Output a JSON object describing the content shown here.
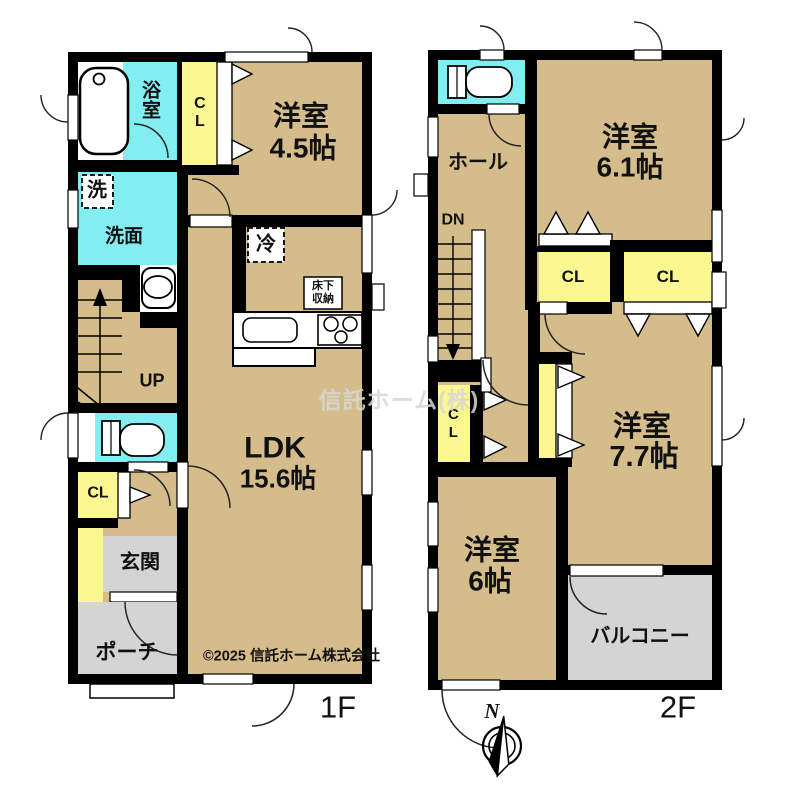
{
  "watermark": "信託ホーム(株)",
  "copyright": "©2025 信託ホーム株式会社",
  "compass": {
    "north": "N"
  },
  "floor1": {
    "label": "1F",
    "bath": "浴室",
    "closet_top": "CL",
    "west_room": "洋室",
    "west_room_size": "4.5帖",
    "laundry": "洗",
    "washroom": "洗面",
    "stairs_up": "UP",
    "fridge": "冷",
    "underfloor_line1": "床下",
    "underfloor_line2": "収納",
    "ldk": "LDK",
    "ldk_size": "15.6帖",
    "closet_lower": "CL",
    "entrance": "玄関",
    "porch": "ポーチ"
  },
  "floor2": {
    "label": "2F",
    "hall": "ホール",
    "stairs_down": "DN",
    "west_room_1": "洋室",
    "west_room_1_size": "6.1帖",
    "closet_a": "CL",
    "closet_b": "CL",
    "closet_c": "CL",
    "west_room_2": "洋室",
    "west_room_2_size": "7.7帖",
    "west_room_3": "洋室",
    "west_room_3_size": "6帖",
    "balcony": "バルコニー"
  },
  "colors": {
    "room_tan": "#d5bd8b",
    "wet_cyan": "#82eef2",
    "closet_yellow": "#faf690",
    "outdoor_gray": "#d4d4d4",
    "wall_black": "#000000"
  }
}
